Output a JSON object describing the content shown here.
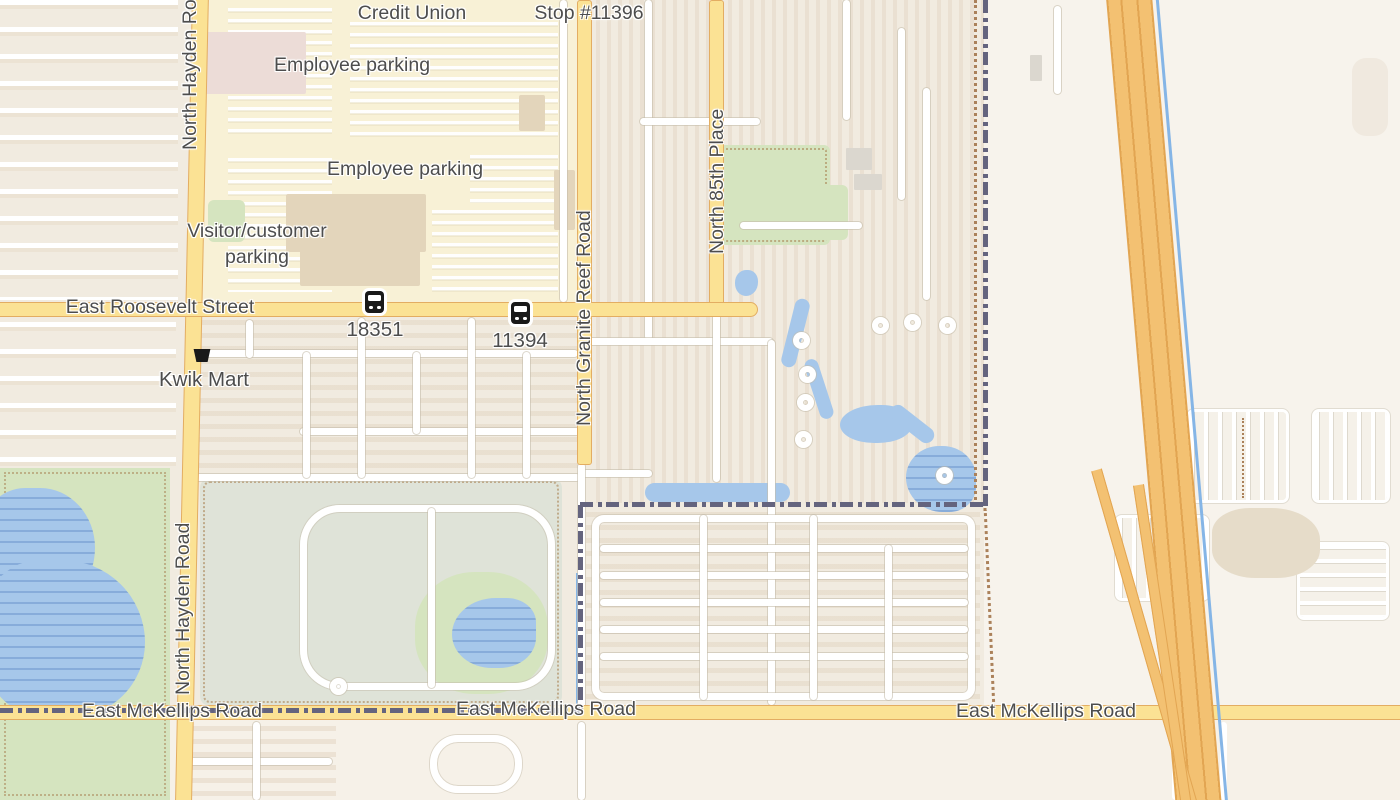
{
  "map_type": "street-map",
  "colors": {
    "background_urban": "#f1ebe0",
    "background_empty": "#f7f3ec",
    "parking_campus": "#f8f1d6",
    "secondary_road_fill": "#fbe294",
    "secondary_road_casing": "#e3ad62",
    "motorway_fill": "#f3c172",
    "motorway_casing": "#e2a552",
    "minor_road": "#ffffff",
    "water": "#a6c7ea",
    "park_green": "#d5e4bf",
    "golf_sage": "#dfe3d8",
    "boundary_dash": "#64647e",
    "path_dotted": "#ab815a",
    "label_text": "#4d4d4d"
  },
  "poi_labels": [
    {
      "name": "credit-union",
      "text": "Credit Union"
    },
    {
      "name": "bus-stop-name",
      "text": "Stop #11396"
    },
    {
      "name": "employee-parking-north",
      "text": "Employee parking"
    },
    {
      "name": "employee-parking-south",
      "text": "Employee parking"
    },
    {
      "name": "visitor-customer-parking",
      "line1": "Visitor/customer",
      "line2": "parking"
    },
    {
      "name": "kwik-mart",
      "text": "Kwik Mart"
    }
  ],
  "bus_stops": [
    {
      "code": "18351"
    },
    {
      "code": "11394"
    }
  ],
  "road_labels": [
    {
      "name": "east-roosevelt-street",
      "text": "East Roosevelt Street"
    },
    {
      "name": "north-hayden-road-top",
      "text": "North Hayden Road"
    },
    {
      "name": "north-hayden-road-mid",
      "text": "North Hayden Road"
    },
    {
      "name": "north-granite-reef-road",
      "text": "North Granite Reef Road"
    },
    {
      "name": "north-85th-place",
      "text": "North 85th Place"
    },
    {
      "name": "east-mckellips-road-west",
      "text": "East McKellips Road"
    },
    {
      "name": "east-mckellips-road-center",
      "text": "East McKellips Road"
    },
    {
      "name": "east-mckellips-road-east",
      "text": "East McKellips Road"
    }
  ],
  "icons": {
    "bus": "bus-icon",
    "shopping_basket": "shopping-basket-icon"
  }
}
